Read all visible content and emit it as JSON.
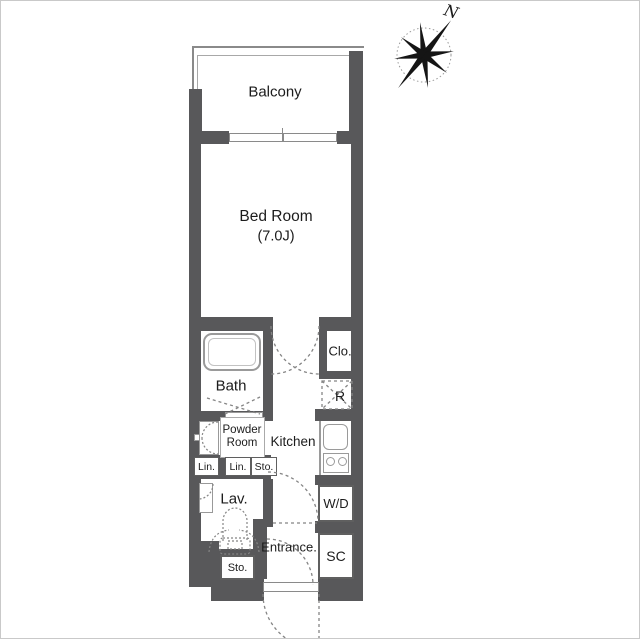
{
  "plan": {
    "labels": {
      "balcony": "Balcony",
      "bedroom": "Bed Room",
      "bedroom_size": "(7.0J)",
      "bath": "Bath",
      "closet": "Clo.",
      "fridge": "R",
      "powder_room": "Powder Room",
      "kitchen": "Kitchen",
      "linen_a": "Lin.",
      "linen_b": "Lin.",
      "storage_mid": "Sto.",
      "lavatory": "Lav.",
      "washer_dryer": "W/D",
      "entrance": "Entrance.",
      "shoe_closet": "SC",
      "storage_bottom": "Sto.",
      "compass_north": "N"
    },
    "colors": {
      "wall": "#58585a",
      "line": "#9a9a9a",
      "dash": "#858585",
      "text": "#1c1c1c",
      "border": "#c9c9c9"
    }
  }
}
